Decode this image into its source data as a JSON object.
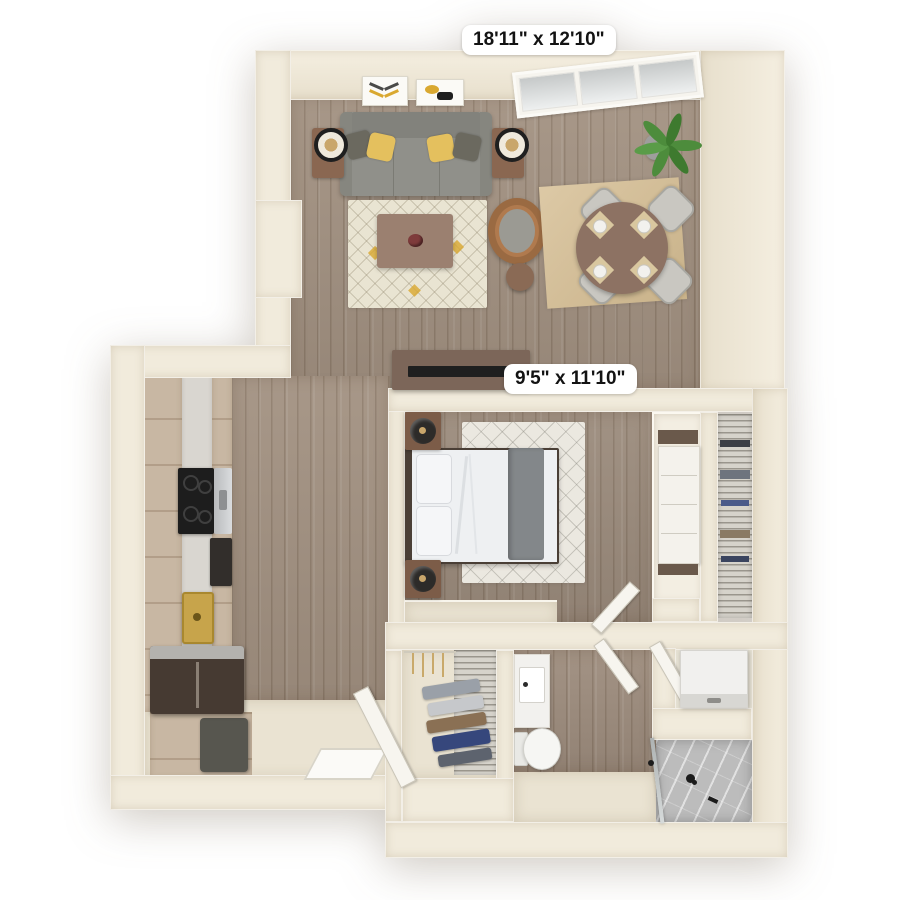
{
  "floorplan": {
    "dimension_labels": [
      {
        "area": "living-dining",
        "text": "18'11\" x 12'10\""
      },
      {
        "area": "bedroom",
        "text": "9'5\" x 11'10\""
      }
    ],
    "areas": [
      "living-room",
      "dining-area",
      "kitchen",
      "entry",
      "hallway",
      "bedroom",
      "walk-in-closet",
      "linen-closet",
      "bathroom",
      "laundry-nook",
      "shower"
    ],
    "window_panes": 3,
    "furniture_and_fixtures": [
      "sofa",
      "throw-pillows",
      "side-table",
      "table-lamp",
      "wall-art",
      "coffee-table",
      "area-rug",
      "armchair",
      "ottoman",
      "dining-table",
      "dining-chair",
      "place-setting",
      "potted-plant",
      "tv-console",
      "tv",
      "bed",
      "nightstand",
      "bedroom-rug",
      "dresser",
      "wire-shelving",
      "hangers",
      "folded-clothes",
      "range",
      "dishwasher",
      "kitchen-sink",
      "refrigerator",
      "kitchen-cabinets",
      "trash-bin",
      "vanity-sink",
      "toilet",
      "washer-dryer",
      "shower-fixtures",
      "glass-partition",
      "entry-door",
      "bedroom-door",
      "bathroom-door",
      "laundry-door"
    ],
    "colors": {
      "background": "#ffffff",
      "wall": "#f1ebdc",
      "wood_floor": "#a29181",
      "bedroom_wood": "#9b8b7c",
      "kitchen_cabinet_wood": "#c8b7a3",
      "beige_floor": "#eae3d2",
      "rug_cream": "#e9e4d2",
      "dining_rug_tan": "#d5bd92",
      "sofa_gray": "#8f8e88",
      "accent_yellow": "#e4c05e",
      "table_brown": "#8d7263",
      "brass_sink": "#c7a44b",
      "marble_shower": "#bcbcbc",
      "label_background": "#ffffff",
      "label_text": "#131313"
    }
  }
}
